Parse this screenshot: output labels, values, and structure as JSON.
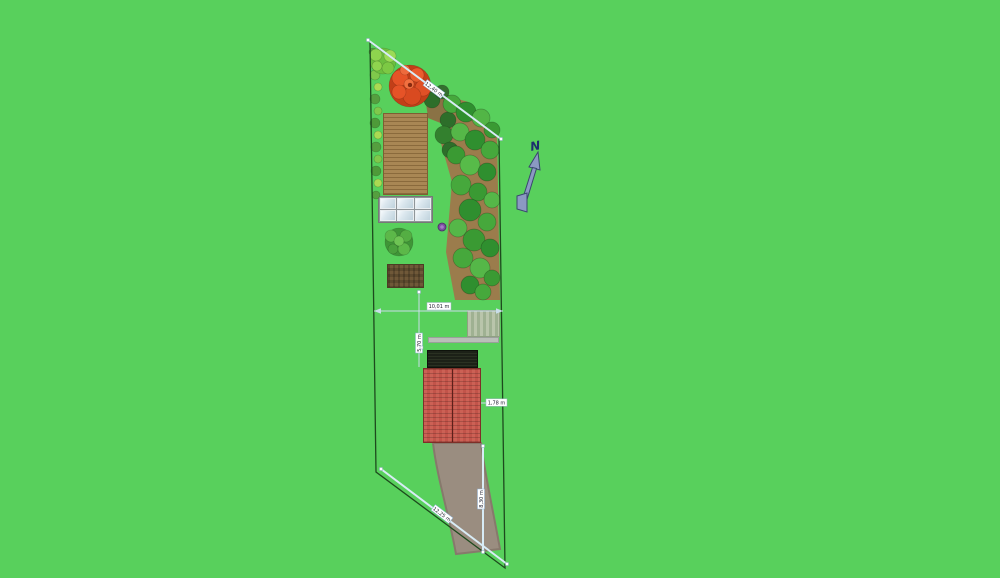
{
  "plan": {
    "north_label": "N",
    "dimension_labels": {
      "top_boundary": "12,40 m",
      "plot_width": "10,01 m",
      "garden_depth": "5,70 m",
      "house_to_boundary": "1,78 m",
      "yard_depth": "8,30 m",
      "bottom_boundary": "12,25 m"
    },
    "colors": {
      "background": "#58d05c",
      "boundary_line": "#1d4a1d",
      "dimension_line": "#d8ecf6",
      "dimension_label_border": "#8fb4d8",
      "north_arrow_fill": "#8b99c2",
      "north_arrow_outline": "#39486e",
      "house_roof_red": "#c65a50",
      "house_roof_dark": "#1c2117",
      "driveway": "#9a8d80",
      "tilled_soil": "#a98754",
      "compost": "#6f5838",
      "deck": "#b9c5ab",
      "woodland_ground": "#9b7c4c",
      "flowering_tree": "#e65327"
    },
    "objects": [
      "plot-boundary",
      "flowering-tree",
      "lime-tree",
      "left-hedge",
      "woodland",
      "tilled-plot",
      "greenhouse",
      "center-shrub",
      "compost-bin",
      "purple-plant",
      "deck",
      "terrace",
      "house-roof-dark",
      "house-roof-red",
      "driveway",
      "north-arrow",
      "dimension-lines"
    ]
  }
}
